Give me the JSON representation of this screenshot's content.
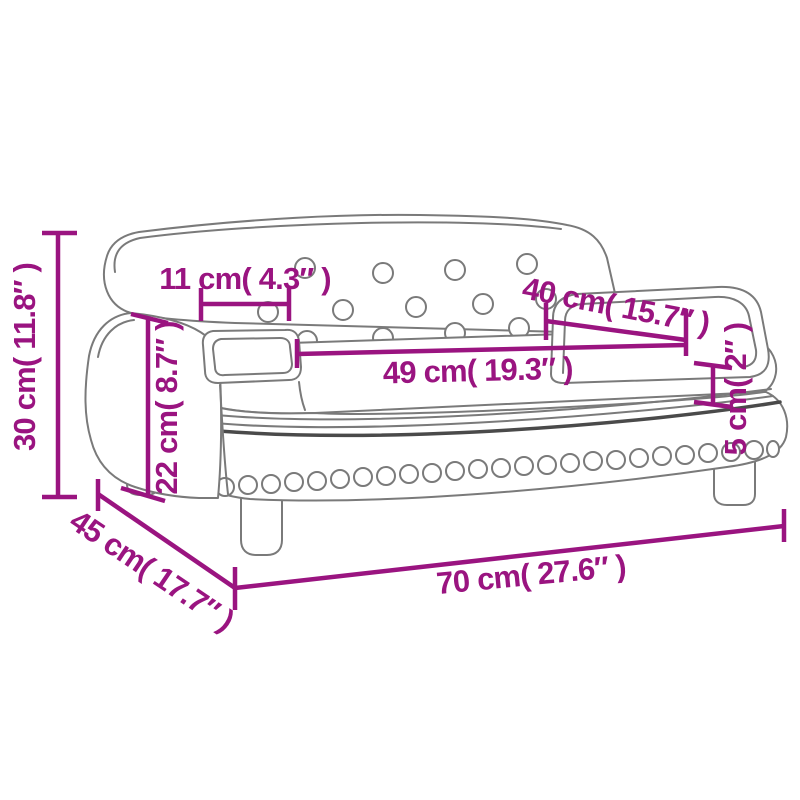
{
  "colors": {
    "dimension": "#9A1480",
    "outline": "#7A7A7A",
    "outline_dark": "#4A4A4A",
    "background": "#FFFFFF"
  },
  "dimensions": {
    "total_height": {
      "label": "30 cm( 11.8″ )"
    },
    "backrest_inset": {
      "label": "11 cm( 4.3″ )"
    },
    "seat_depth": {
      "label": "40 cm( 15.7″ )"
    },
    "seat_width": {
      "label": "49 cm( 19.3″ )"
    },
    "seat_height": {
      "label": "22 cm( 8.7″ )"
    },
    "cushion_thickness": {
      "label": "5 cm( 2″ )"
    },
    "total_depth": {
      "label": "45 cm( 17.7″ )"
    },
    "total_width": {
      "label": "70 cm( 27.6″ )"
    }
  }
}
